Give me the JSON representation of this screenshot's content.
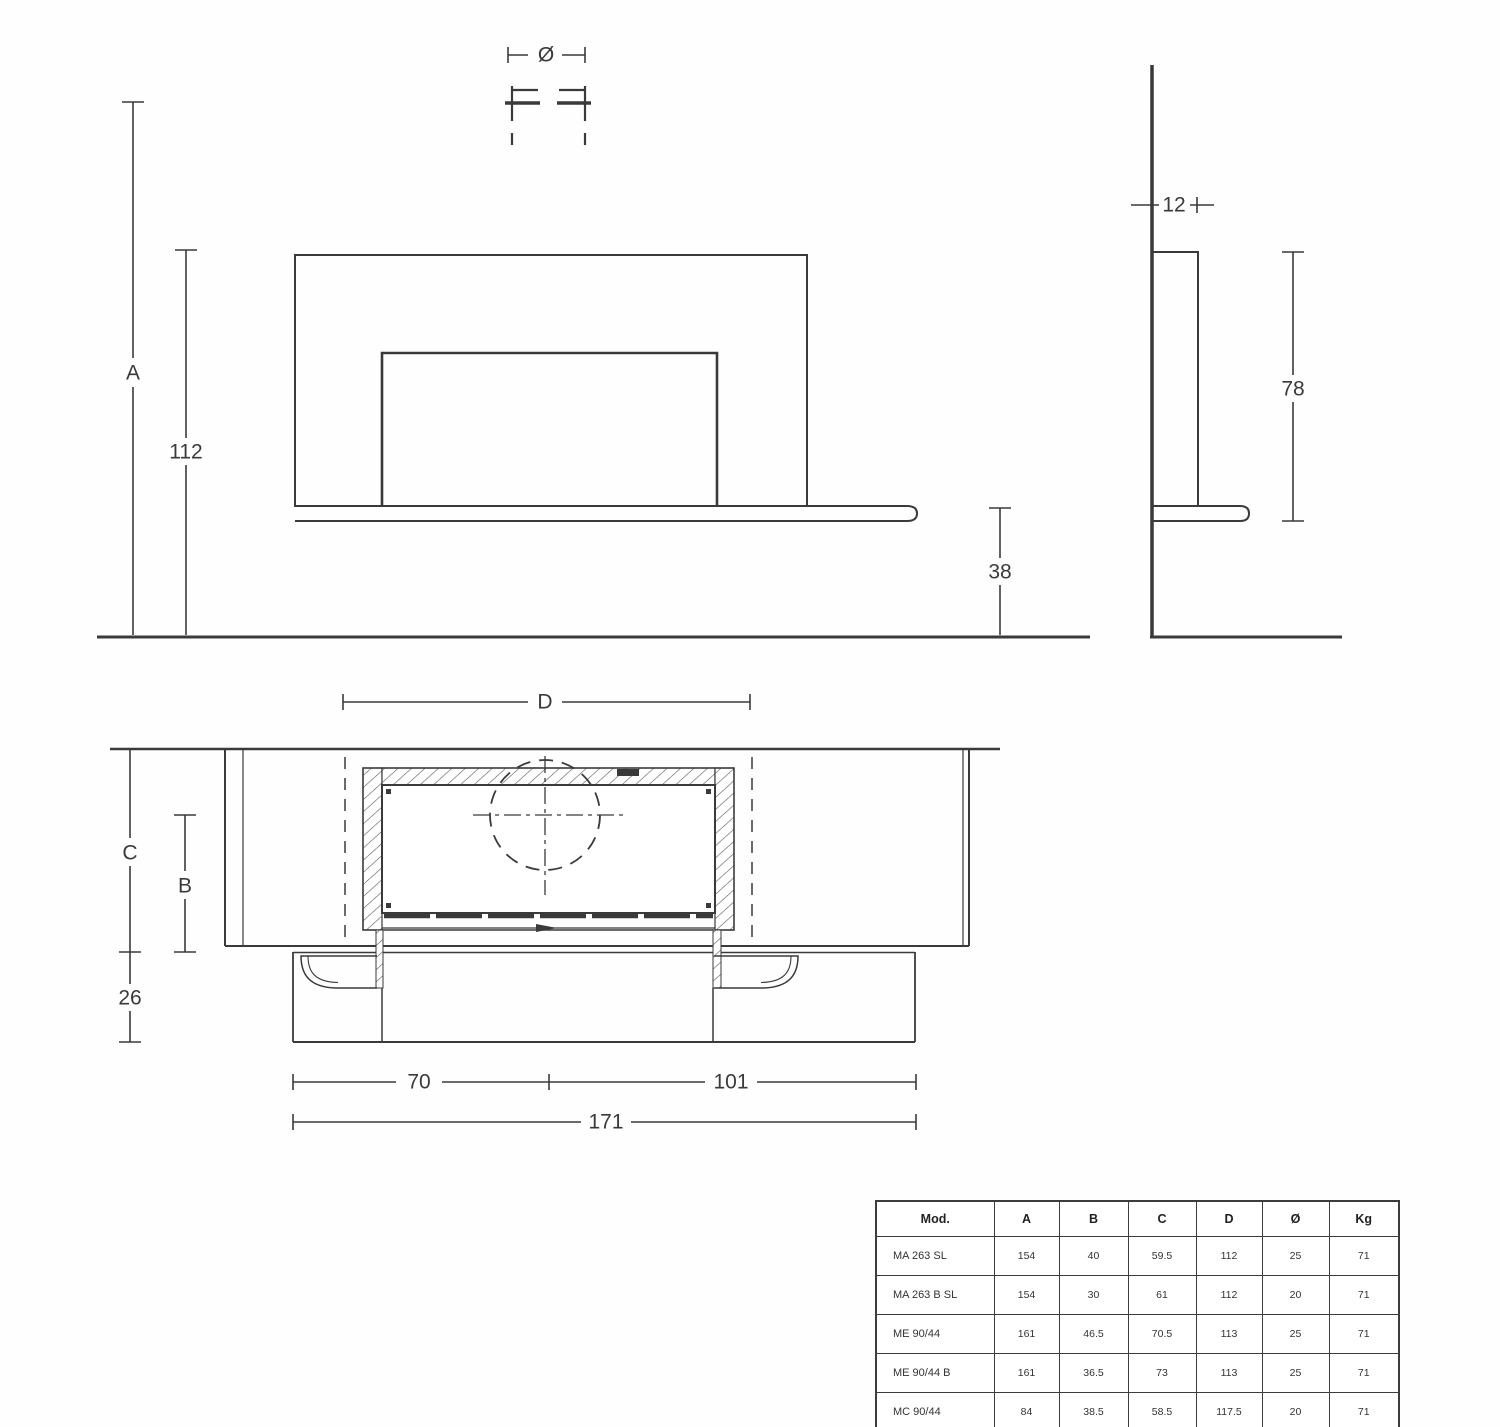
{
  "page": {
    "background": "#fefefe",
    "line_color": "#3a3a3a"
  },
  "front_view": {
    "dims": {
      "diameter_symbol": "Ø",
      "height_total": "A",
      "height_112": "112",
      "bench_height": "38"
    }
  },
  "side_view": {
    "dims": {
      "depth_top": "12",
      "height_78": "78"
    }
  },
  "plan_view": {
    "dims": {
      "width_d": "D",
      "depth_c": "C",
      "depth_b": "B",
      "depth_26": "26",
      "width_70": "70",
      "width_101": "101",
      "width_171": "171"
    }
  },
  "table": {
    "headers": [
      "Mod.",
      "A",
      "B",
      "C",
      "D",
      "Ø",
      "Kg"
    ],
    "rows": [
      [
        "MA 263 SL",
        "154",
        "40",
        "59.5",
        "112",
        "25",
        "71"
      ],
      [
        "MA 263 B SL",
        "154",
        "30",
        "61",
        "112",
        "20",
        "71"
      ],
      [
        "ME 90/44",
        "161",
        "46.5",
        "70.5",
        "113",
        "25",
        "71"
      ],
      [
        "ME 90/44 B",
        "161",
        "36.5",
        "73",
        "113",
        "25",
        "71"
      ],
      [
        "MC 90/44",
        "84",
        "38.5",
        "58.5",
        "117.5",
        "20",
        "71"
      ],
      [
        "IC 90",
        "91.5",
        "32.5",
        "59",
        "103",
        "15",
        "71"
      ]
    ]
  }
}
